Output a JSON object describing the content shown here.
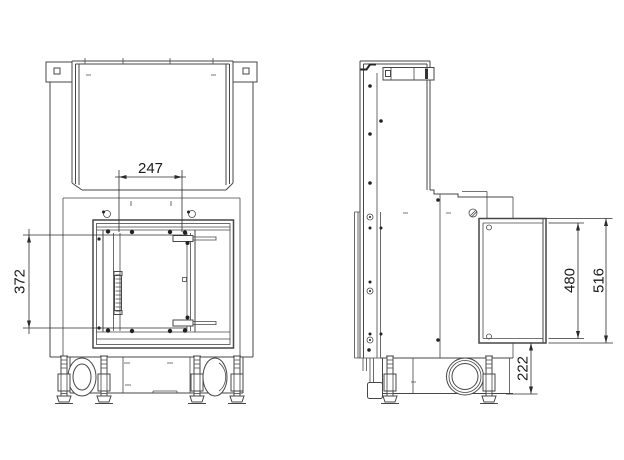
{
  "drawing": {
    "background": "#ffffff",
    "line_color": "#474747",
    "dim_color": "#2f2f2f",
    "dimensions": {
      "front_opening_width": "247",
      "front_opening_height": "372",
      "side_panel_inner_height": "480",
      "side_panel_total_height": "516",
      "side_base_height": "222"
    }
  }
}
